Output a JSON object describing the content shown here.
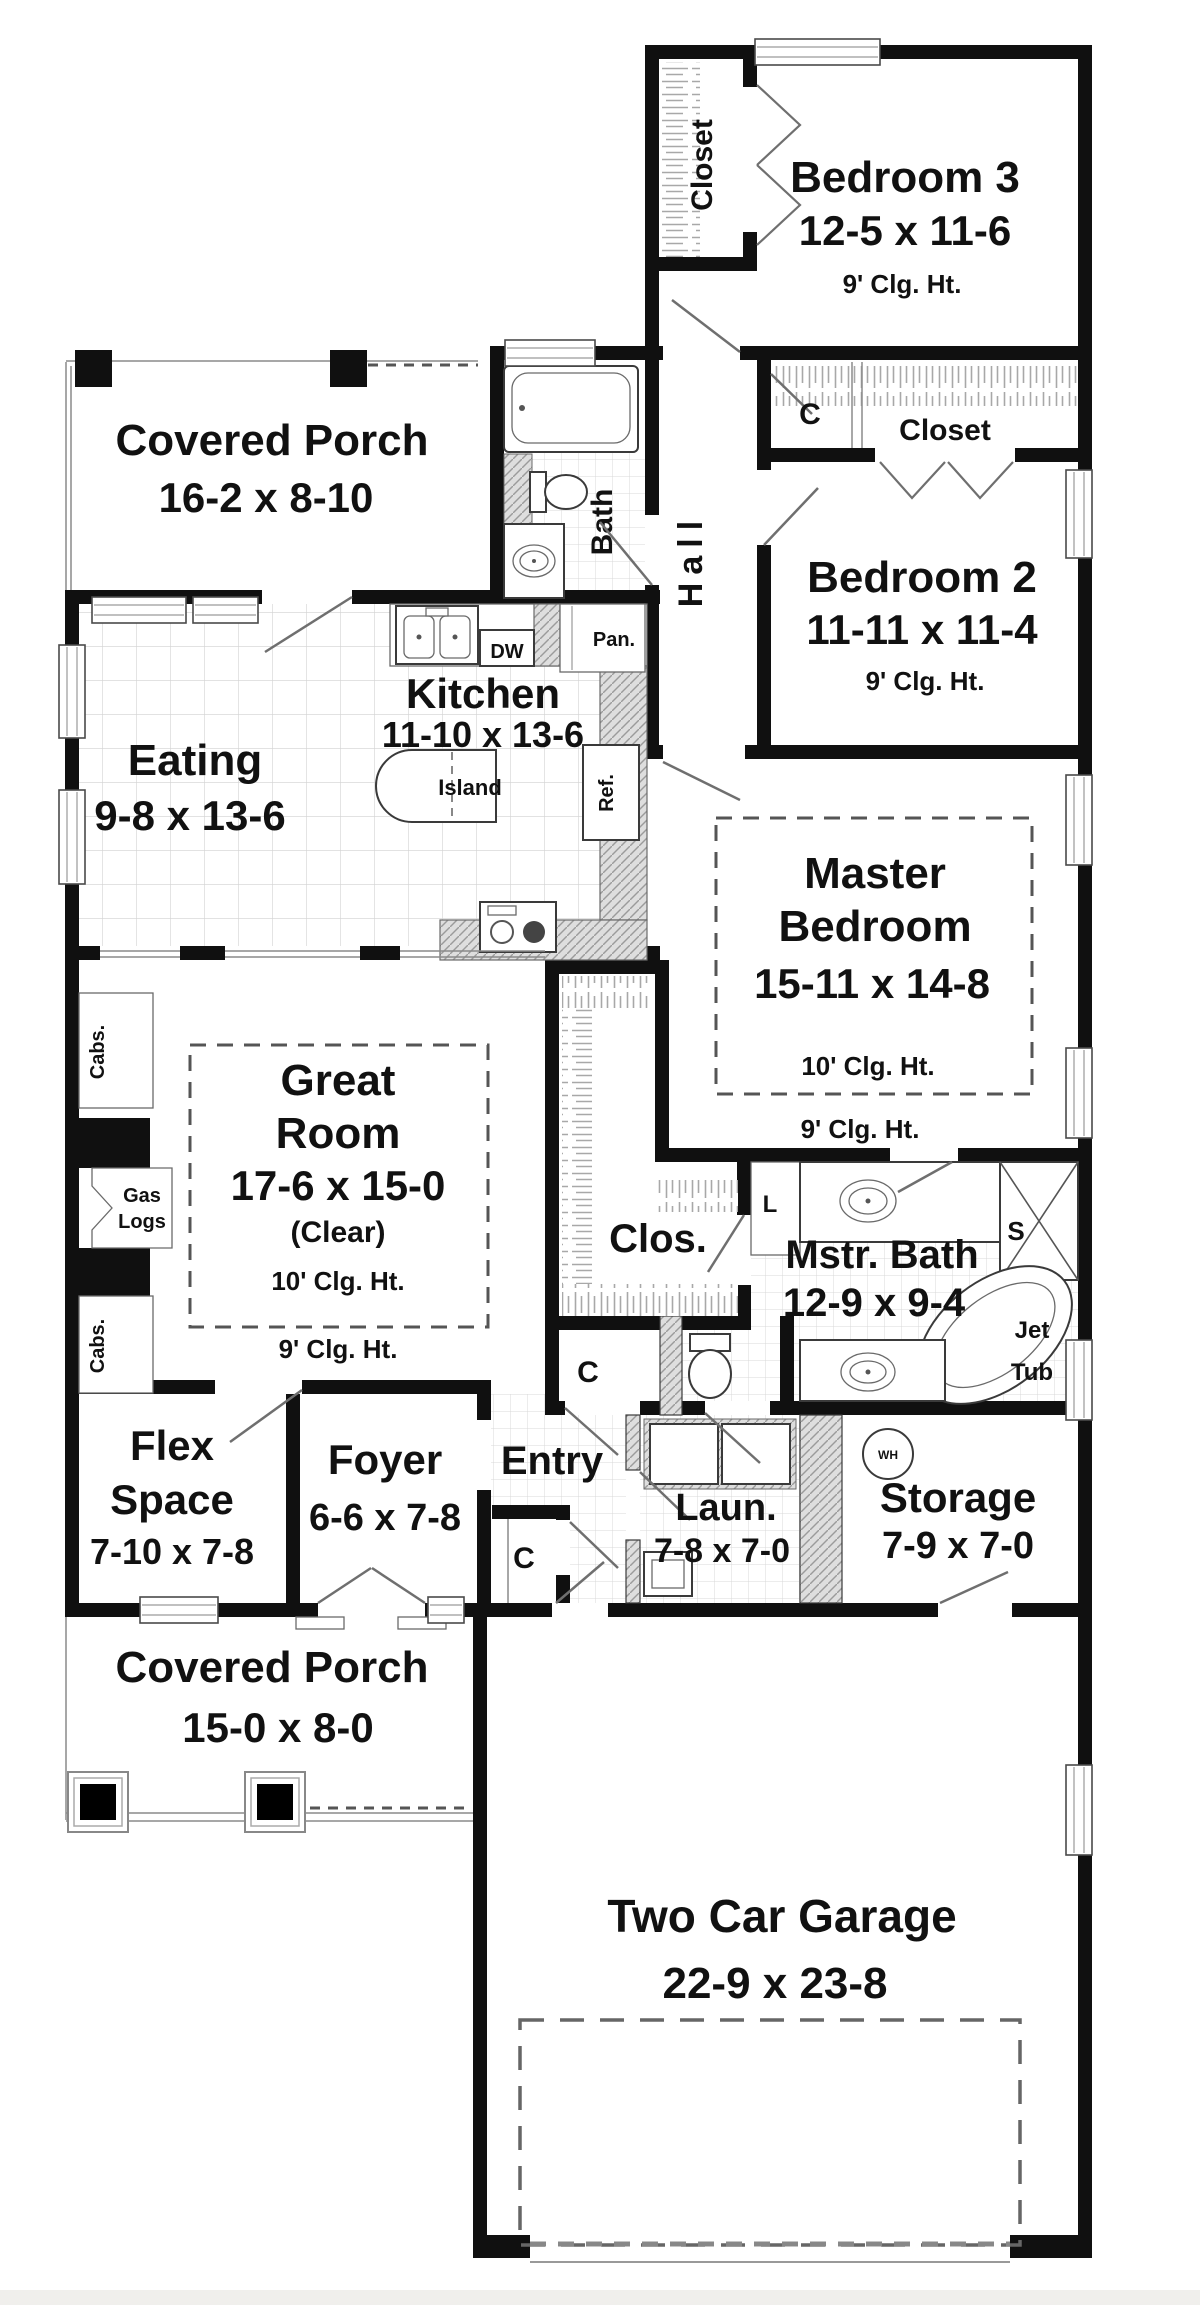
{
  "title": "First floor plan",
  "rooms": {
    "bedroom3": {
      "name": "Bedroom 3",
      "dims": "12-5 x 11-6",
      "ceiling": "9' Clg. Ht."
    },
    "bedroom2": {
      "name": "Bedroom 2",
      "dims": "11-11 x 11-4",
      "ceiling": "9' Clg. Ht."
    },
    "master_bedroom": {
      "name1": "Master",
      "name2": "Bedroom",
      "dims": "15-11 x 14-8",
      "ceiling_inner": "10' Clg. Ht.",
      "ceiling_outer": "9' Clg. Ht."
    },
    "great_room": {
      "name1": "Great",
      "name2": "Room",
      "dims": "17-6 x 15-0",
      "clear": "(Clear)",
      "ceiling_inner": "10' Clg. Ht.",
      "ceiling_outer": "9' Clg. Ht."
    },
    "kitchen": {
      "name": "Kitchen",
      "dims": "11-10 x 13-6"
    },
    "eating": {
      "name": "Eating",
      "dims": "9-8 x 13-6"
    },
    "bath": {
      "name": "Bath"
    },
    "hall": {
      "name": "Hall"
    },
    "master_bath": {
      "name": "Mstr. Bath",
      "dims": "12-9 x 9-4"
    },
    "master_closet": {
      "name": "Clos."
    },
    "porch_top": {
      "name": "Covered Porch",
      "dims": "16-2 x 8-10"
    },
    "porch_bottom": {
      "name": "Covered Porch",
      "dims": "15-0 x 8-0"
    },
    "flex": {
      "name1": "Flex",
      "name2": "Space",
      "dims": "7-10 x 7-8"
    },
    "foyer": {
      "name": "Foyer",
      "dims": "6-6 x 7-8"
    },
    "entry": {
      "name": "Entry"
    },
    "laundry": {
      "name": "Laun.",
      "dims": "7-8 x 7-0"
    },
    "storage": {
      "name": "Storage",
      "dims": "7-9 x 7-0"
    },
    "garage": {
      "name": "Two Car Garage",
      "dims": "22-9 x 23-8"
    },
    "bed3_closet": {
      "name": "Closet"
    },
    "bed2_closet": {
      "name": "Closet"
    }
  },
  "fixtures": {
    "island": "Island",
    "dishwasher": "DW",
    "pantry": "Pan.",
    "refrigerator": "Ref.",
    "gas_logs_line1": "Gas",
    "gas_logs_line2": "Logs",
    "cabinets": "Cabs.",
    "linen": "L",
    "shower": "S",
    "jet_tub_line1": "Jet",
    "jet_tub_line2": "Tub",
    "water_heater": "WH",
    "small_closet": "C"
  },
  "colors": {
    "wall": "#101010",
    "paper": "#ffffff",
    "grid": "#d2d2d2",
    "hatch": "#9b9b9b",
    "counter_bg": "#dedede"
  }
}
